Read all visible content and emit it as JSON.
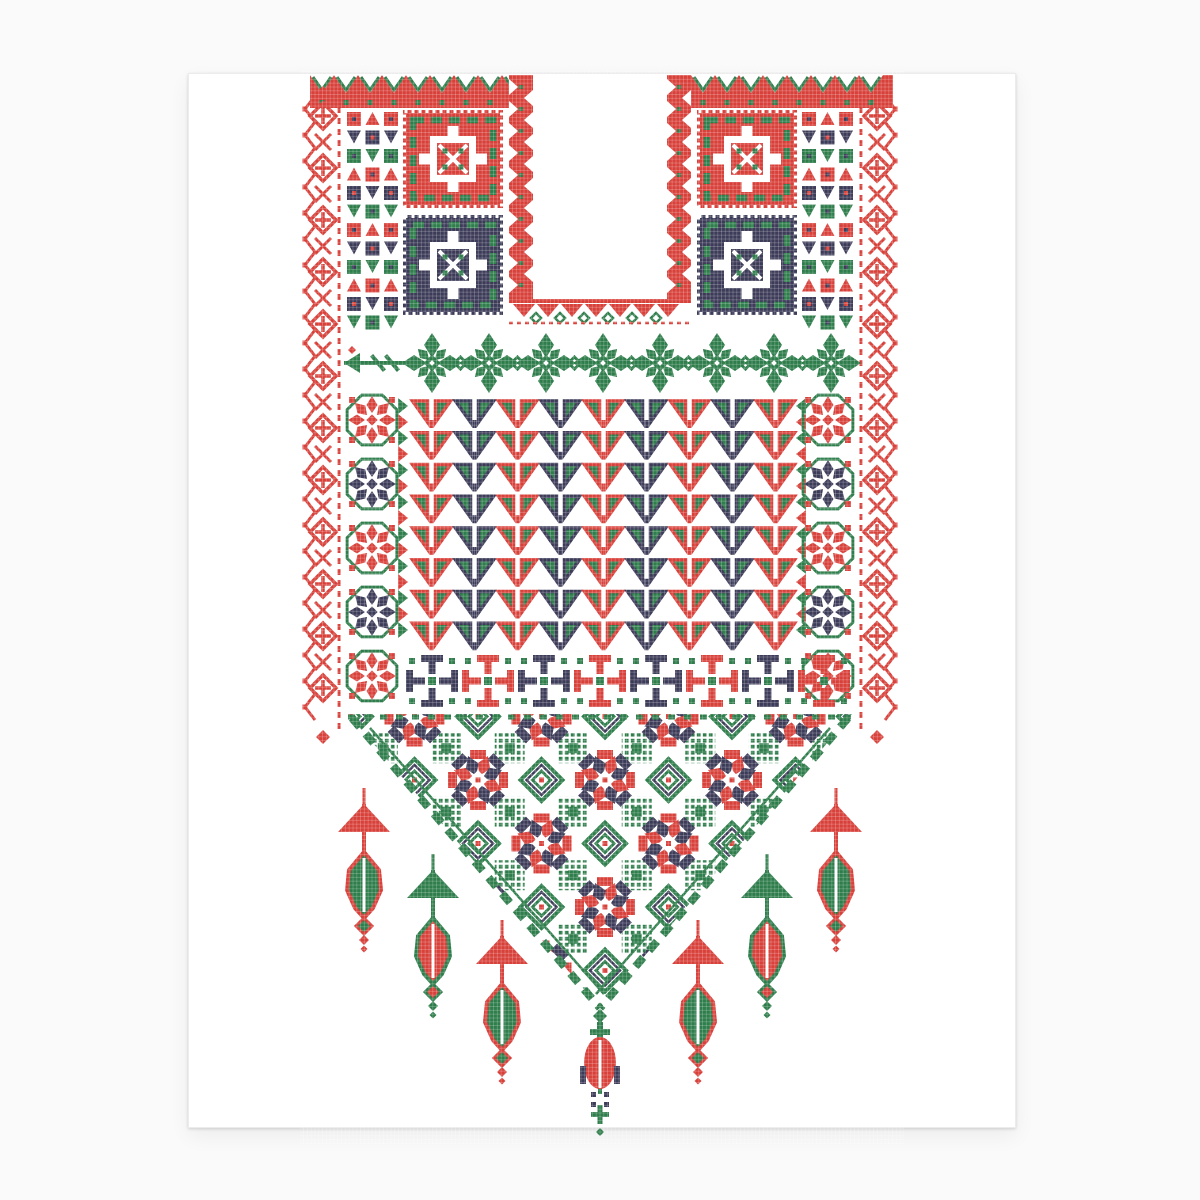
{
  "canvas": {
    "width": 1200,
    "height": 1200,
    "background": "#fafafa"
  },
  "page": {
    "x": 188,
    "y": 73,
    "width": 826,
    "height": 1053,
    "fill": "#ffffff"
  },
  "palette": {
    "red": "#d8403a",
    "green": "#2e7d4b",
    "navy": "#3c3b58",
    "white": "#ffffff"
  },
  "pattern": {
    "regions": [
      {
        "type": "top_band",
        "name": "top-zigzag-border",
        "segments": [
          [
            310,
            533
          ],
          [
            667,
            893
          ]
        ],
        "y": 75,
        "h": 33
      },
      {
        "type": "lace",
        "name": "left-lace-border",
        "x": 323,
        "y1": 96,
        "y2": 732,
        "outer": "left"
      },
      {
        "type": "lace",
        "name": "right-lace-border",
        "x": 877,
        "y1": 96,
        "y2": 732,
        "outer": "right"
      },
      {
        "type": "mosaic",
        "name": "left-mosaic-column",
        "x": 345,
        "y": 110,
        "w": 55,
        "h": 224
      },
      {
        "type": "mosaic",
        "name": "right-mosaic-column",
        "x": 800,
        "y": 110,
        "w": 55,
        "h": 224
      },
      {
        "type": "key_block",
        "name": "left-red-key-block",
        "x": 403,
        "y": 110,
        "w": 100,
        "h": 98,
        "base": "red"
      },
      {
        "type": "key_block",
        "name": "left-navy-key-block",
        "x": 403,
        "y": 215,
        "w": 100,
        "h": 100,
        "base": "navy"
      },
      {
        "type": "key_block",
        "name": "right-red-key-block",
        "x": 697,
        "y": 110,
        "w": 100,
        "h": 98,
        "base": "red"
      },
      {
        "type": "key_block",
        "name": "right-navy-key-block",
        "x": 697,
        "y": 215,
        "w": 100,
        "h": 100,
        "base": "navy"
      },
      {
        "type": "neck_strip",
        "name": "neck-band-left",
        "x": 509,
        "y": 75,
        "w": 24,
        "h": 224
      },
      {
        "type": "neck_strip",
        "name": "neck-band-right",
        "x": 667,
        "y": 75,
        "w": 24,
        "h": 224
      },
      {
        "type": "neck_bottom",
        "name": "neck-band-bottom",
        "x": 509,
        "y": 299,
        "w": 182,
        "h": 26
      },
      {
        "type": "flower_band",
        "name": "green-flower-band",
        "cy": 363,
        "start": 432,
        "step": 57,
        "count": 8,
        "sprig_x": 344
      },
      {
        "type": "hst",
        "name": "left-hst-strip",
        "x": 398,
        "y": 398,
        "w": 10,
        "h": 254,
        "dir": 1
      },
      {
        "type": "hst",
        "name": "right-hst-strip",
        "x": 796,
        "y": 398,
        "w": 10,
        "h": 254,
        "dir": -1
      },
      {
        "type": "field",
        "name": "triangle-motif-field",
        "x": 410,
        "y": 398,
        "cols": 9,
        "rows": 8,
        "cw": 43,
        "ch": 31.75
      },
      {
        "type": "stars",
        "name": "left-star-column",
        "cx": 372,
        "top": 420,
        "step": 64,
        "count": 5
      },
      {
        "type": "stars",
        "name": "right-star-column",
        "cx": 828,
        "top": 420,
        "step": 64,
        "count": 5
      },
      {
        "type": "pinwheels",
        "name": "pinwheel-band",
        "cy": 681,
        "start": 432,
        "step": 56,
        "count": 8
      },
      {
        "type": "lattice",
        "name": "bottom-lattice-triangle",
        "x1": 348,
        "x2": 852,
        "ytop": 714,
        "ax": 600,
        "ay": 1008,
        "g": 63.5,
        "ox": 414.5,
        "oy": 716.5
      },
      {
        "type": "tassel",
        "name": "tassel-ornament-1",
        "cx": 364,
        "top": 788,
        "a": "red",
        "b": "green"
      },
      {
        "type": "tassel",
        "name": "tassel-ornament-2",
        "cx": 433,
        "top": 854,
        "a": "green",
        "b": "red"
      },
      {
        "type": "tassel",
        "name": "tassel-ornament-3",
        "cx": 502,
        "top": 920,
        "a": "red",
        "b": "green"
      },
      {
        "type": "tassel",
        "name": "tassel-ornament-4",
        "cx": 698,
        "top": 920,
        "a": "red",
        "b": "green"
      },
      {
        "type": "tassel",
        "name": "tassel-ornament-5",
        "cx": 767,
        "top": 854,
        "a": "green",
        "b": "red"
      },
      {
        "type": "tassel",
        "name": "tassel-ornament-6",
        "cx": 836,
        "top": 788,
        "a": "red",
        "b": "green"
      },
      {
        "type": "center_drop",
        "name": "center-drop-ornament",
        "cx": 600,
        "top": 1008
      }
    ]
  }
}
